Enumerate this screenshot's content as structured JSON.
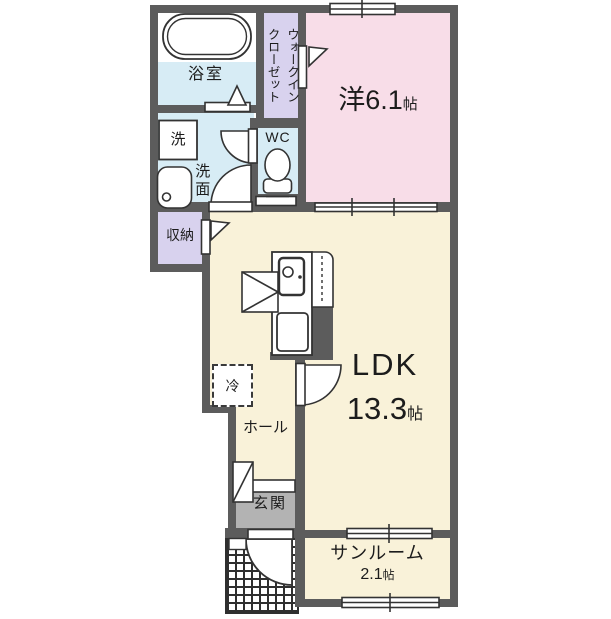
{
  "floorplan": {
    "rooms": {
      "bathroom": {
        "label": "浴室"
      },
      "walk_in_closet": {
        "label": "ウォークインクローゼット",
        "lines": [
          "ウォークイン",
          "クローゼット"
        ]
      },
      "western_room": {
        "label": "洋",
        "size": "6.1",
        "unit": "帖"
      },
      "laundry": {
        "label": "洗"
      },
      "washroom": {
        "label": "洗面"
      },
      "toilet": {
        "label": "WC"
      },
      "storage": {
        "label": "収納"
      },
      "refrigerator": {
        "label": "冷"
      },
      "ldk": {
        "label": "LDK",
        "size": "13.3",
        "unit": "帖"
      },
      "hall": {
        "label": "ホール"
      },
      "entrance": {
        "label": "玄関"
      },
      "sunroom": {
        "label": "サンルーム",
        "size": "2.1",
        "unit": "帖"
      }
    },
    "colors": {
      "wall": "#5c5c5c",
      "room_beige": "#f9f2d9",
      "room_pink": "#f8dde8",
      "room_blue": "#d7ecf5",
      "room_purple": "#d8d2ee",
      "entrance_gray": "#b3b3b3",
      "fixture_line": "#333333"
    }
  }
}
